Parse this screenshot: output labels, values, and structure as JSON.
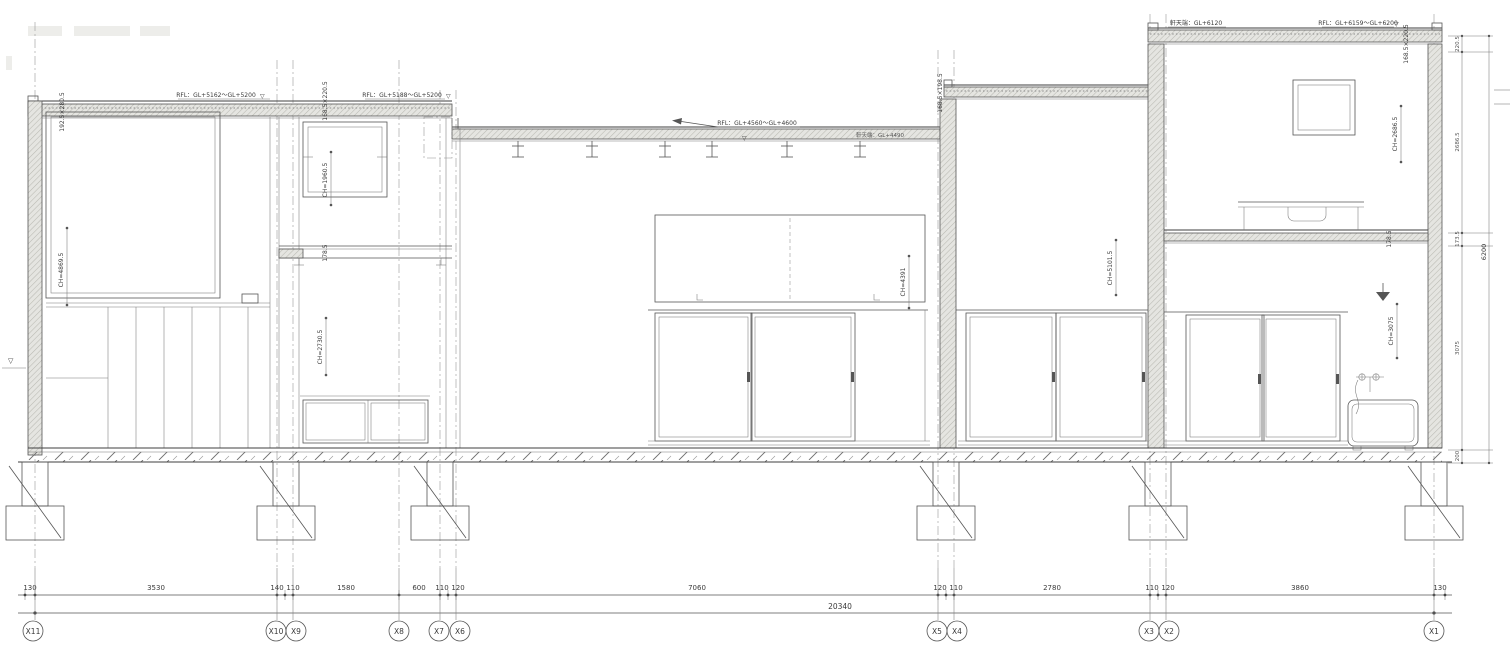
{
  "labels": {
    "tri": "▽",
    "rfl_a": "RFL：GL+5162～GL+5200",
    "rfl_b": "RFL：GL+5188～GL+5200",
    "rfl_c": "RFL：GL+4560～GL+4600",
    "eave_c": "軒天端：GL+4490",
    "eave_e": "軒天端：GL+6120",
    "rfl_e": "RFL：GL+6159～GL+6200"
  },
  "sizes": {
    "roof_a": "192.5×280.5",
    "roof_b": "168.5×220.5",
    "roof_d": "168.5×198.5",
    "roof_e": "168.5×220.5",
    "beam_b": "178.5",
    "beam_e": "178.5"
  },
  "ch": {
    "a": "CH=4869.5",
    "b_win": "CH=1960.5",
    "b": "CH=2730.5",
    "c": "CH=4391",
    "d": "CH=5101.5",
    "e2f": "CH=2686.5",
    "e1f": "CH=3075"
  },
  "dims": [
    "130",
    "3530",
    "140",
    "110",
    "1580",
    "600",
    "110",
    "120",
    "7060",
    "120",
    "110",
    "2780",
    "110",
    "120",
    "3860",
    "130"
  ],
  "total": "20340",
  "vdims": {
    "segs": [
      "220.5",
      "2686.5",
      "173.5",
      "3075",
      "200"
    ],
    "total": "6200"
  },
  "grids": [
    "X11",
    "X10",
    "X9",
    "X8",
    "X7",
    "X6",
    "X5",
    "X4",
    "X3",
    "X2",
    "X1"
  ]
}
